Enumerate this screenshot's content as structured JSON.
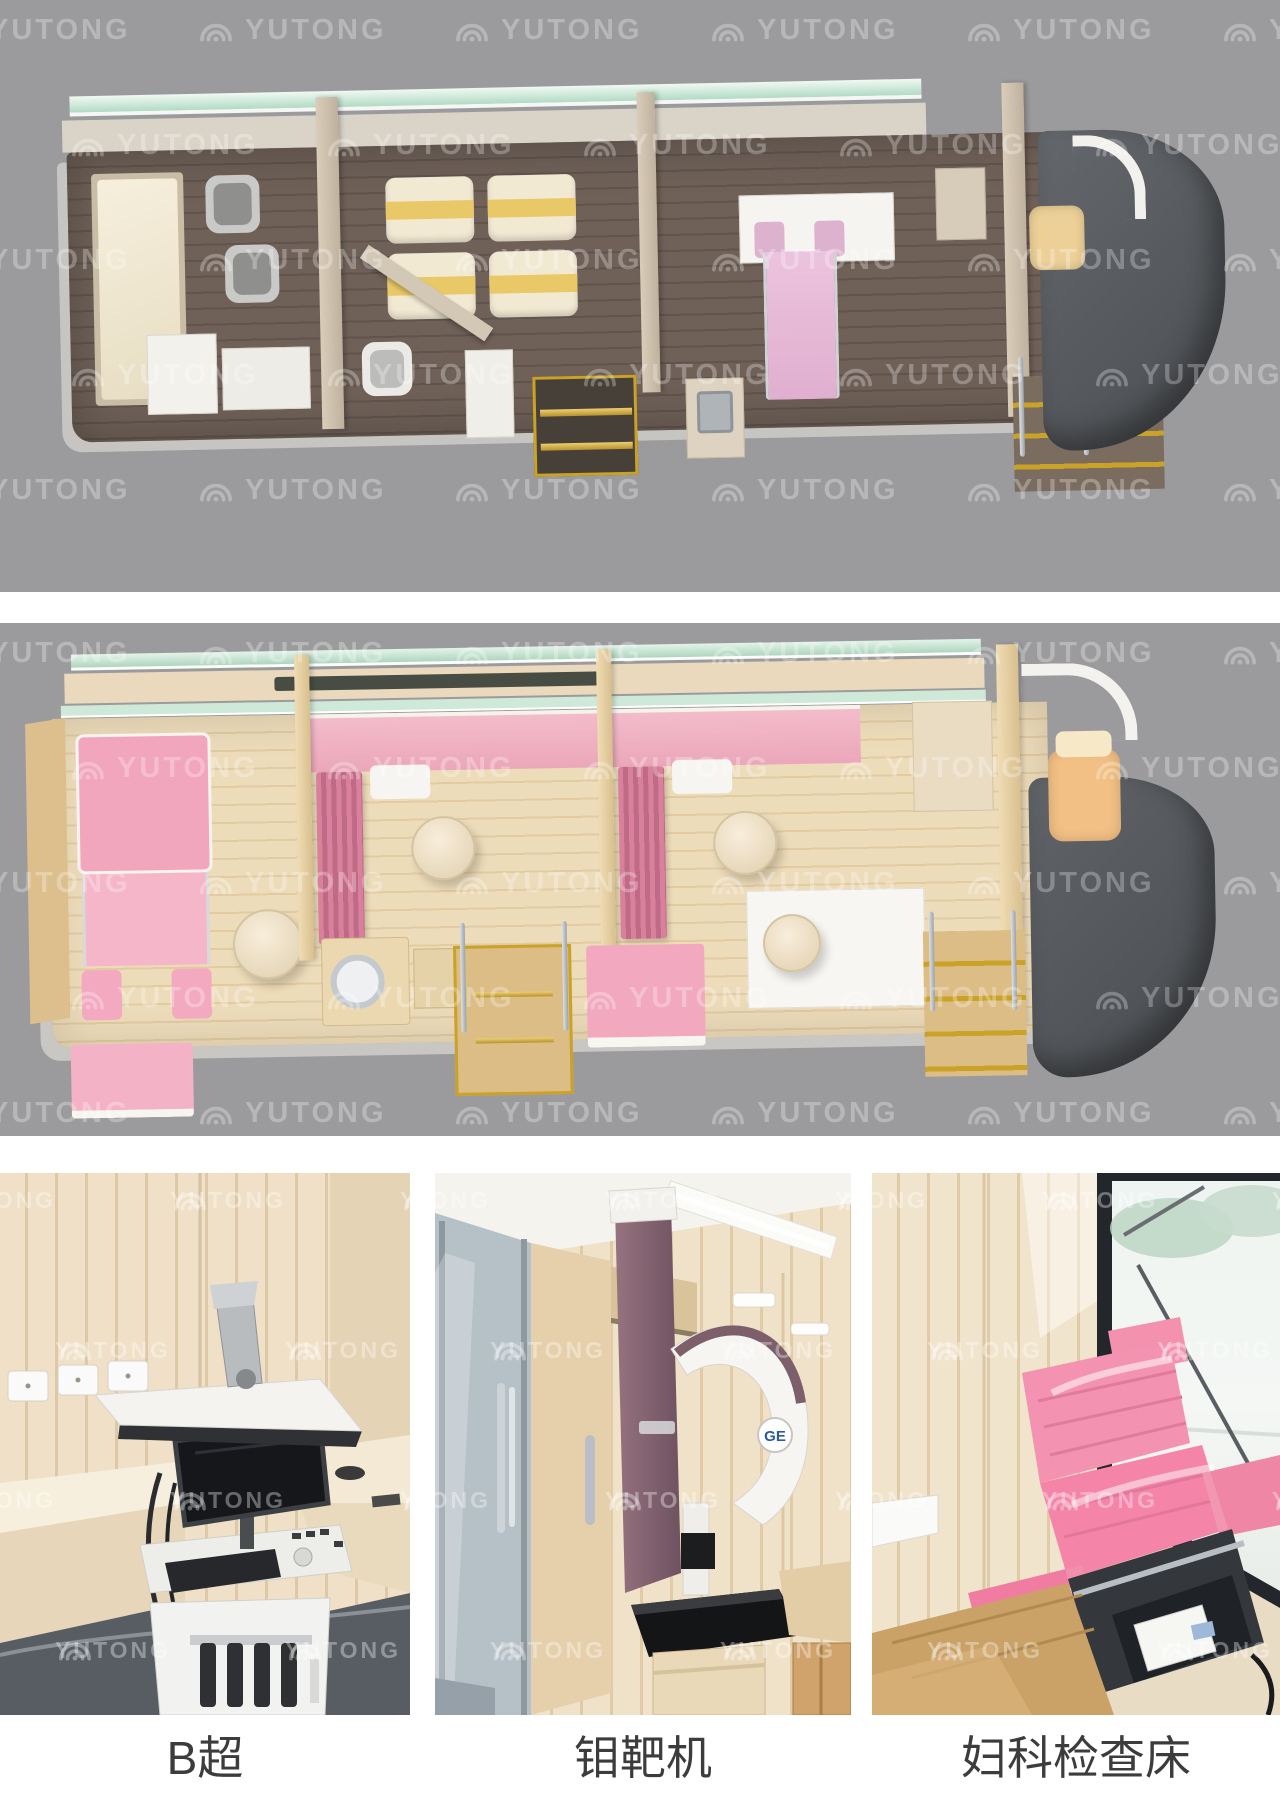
{
  "watermark": {
    "text": "YUTONG"
  },
  "photos": [
    {
      "caption": "B超"
    },
    {
      "caption": "钼靶机",
      "brand_badge": "GE"
    },
    {
      "caption": "妇科检查床"
    }
  ],
  "colors": {
    "panel_background": "#9b9b9d",
    "glass_green": "#b2dbc5",
    "gold_trim": "#c9a227",
    "pink_accent": "#f2a9bf",
    "dark_floor_wood": "#6f6158",
    "light_floor_wood": "#eddcba",
    "caption_text": "#3c3c3c"
  }
}
